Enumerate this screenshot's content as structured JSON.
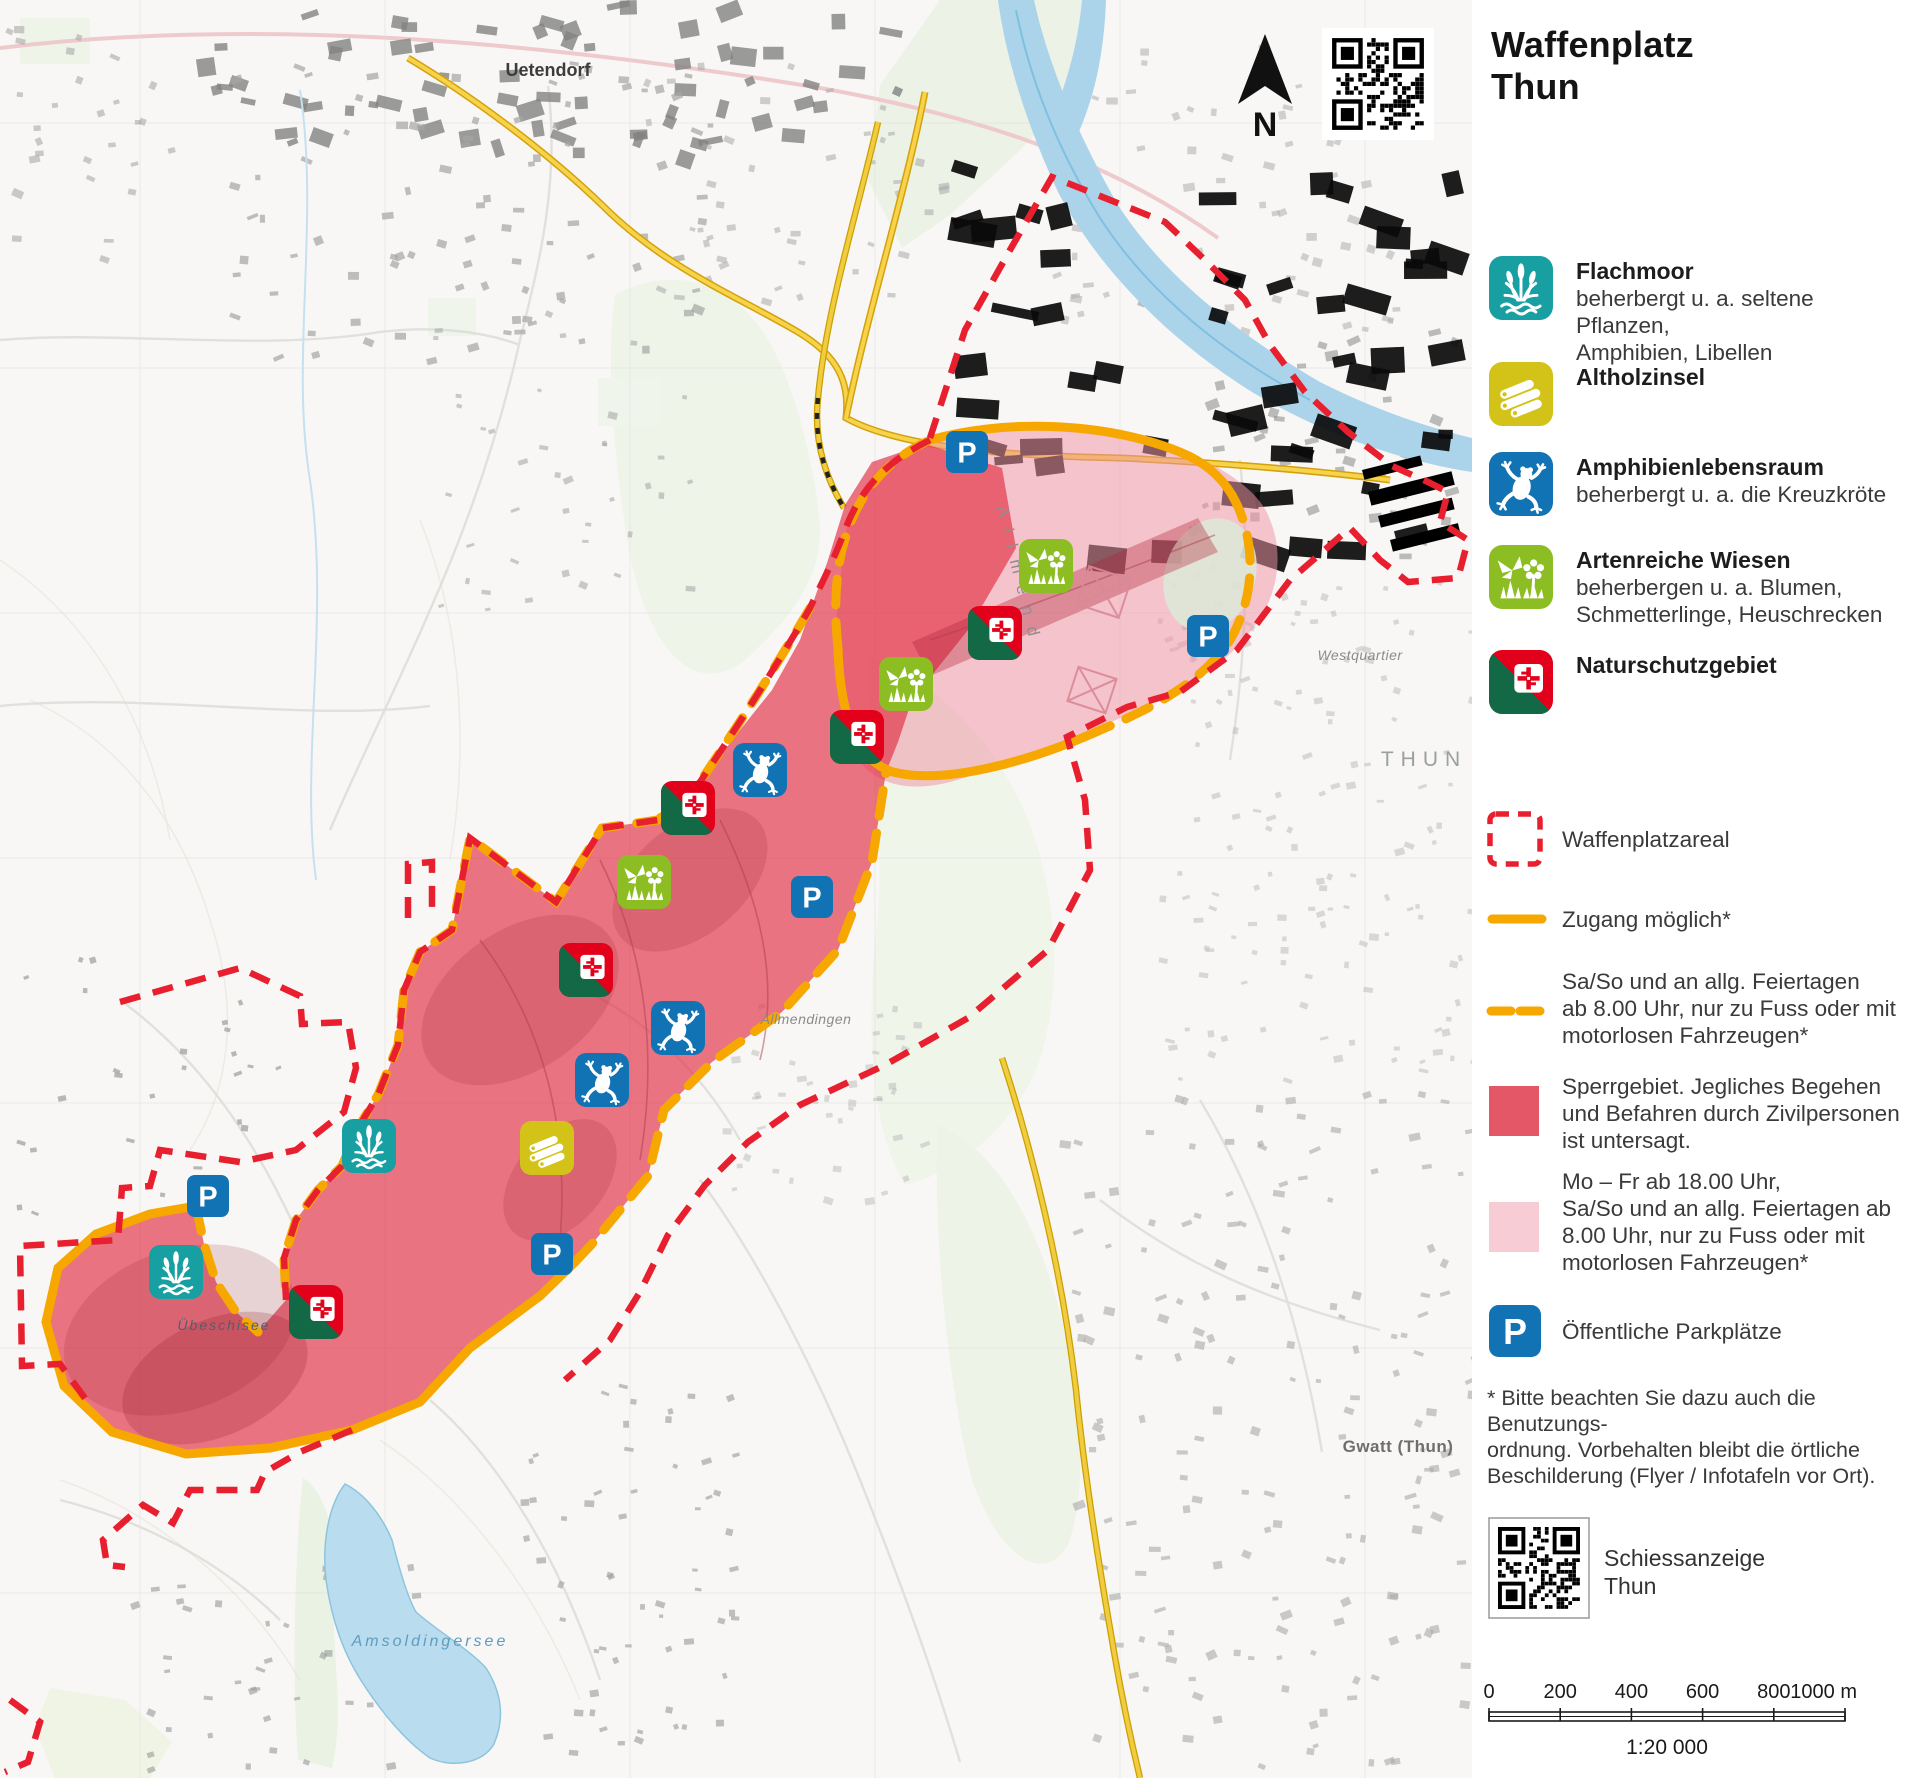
{
  "title": {
    "line1": "Waffenplatz",
    "line2": "Thun"
  },
  "compass": {
    "letter": "N"
  },
  "colors": {
    "teal": "#189fa2",
    "yellow": "#d3c318",
    "blue": "#1273b4",
    "green": "#8cbe23",
    "dark_green": "#136945",
    "swiss_red": "#e3001b",
    "boundary_red": "#e81f2e",
    "orange": "#f6a700",
    "sperr_red": "#e45767",
    "zone_pink": "#f7ccd4"
  },
  "legend": {
    "nature_items": [
      {
        "title": "Flachmoor",
        "desc": [
          "beherbergt u. a. seltene Pflanzen,",
          "Amphibien, Libellen"
        ]
      },
      {
        "title": "Altholzinsel",
        "desc": []
      },
      {
        "title": "Amphibienlebensraum",
        "desc": [
          "beherbergt u. a. die Kreuzkröte"
        ]
      },
      {
        "title": "Artenreiche Wiesen",
        "desc": [
          "beherbergen u. a. Blumen,",
          "Schmetterlinge, Heuschrecken"
        ]
      },
      {
        "title": "Naturschutzgebiet",
        "desc": []
      }
    ],
    "area_items": {
      "waffenplatzareal": "Waffenplatzareal",
      "zugang": "Zugang möglich*",
      "saso": [
        "Sa/So und an allg. Feiertagen",
        "ab 8.00 Uhr, nur zu Fuss oder mit",
        "motorlosen Fahrzeugen*"
      ],
      "sperr": [
        "Sperrgebiet. Jegliches Begehen",
        "und Befahren durch Zivilpersonen",
        "ist untersagt."
      ],
      "mofr": [
        "Mo – Fr ab 18.00 Uhr,",
        "Sa/So und an allg. Feiertagen ab",
        "8.00 Uhr, nur zu Fuss oder mit",
        "motorlosen Fahrzeugen*"
      ],
      "parking": "Öffentliche Parkplätze"
    },
    "footnote": [
      "* Bitte beachten Sie dazu auch die Benutzungs-",
      "ordnung. Vorbehalten bleibt die örtliche",
      "Beschilderung (Flyer / Infotafeln vor Ort)."
    ],
    "qr_label": [
      "Schiessanzeige",
      "Thun"
    ]
  },
  "scalebar": {
    "labels": [
      "0",
      "200",
      "400",
      "600",
      "800",
      "1000 m"
    ],
    "ratio": "1:20 000"
  },
  "map": {
    "labels": [
      {
        "t": "Uetendorf",
        "x": 548,
        "y": 76,
        "cls": "town"
      },
      {
        "t": "THUN",
        "x": 1424,
        "y": 766,
        "cls": "city"
      },
      {
        "t": "Westquartier",
        "x": 1360,
        "y": 660,
        "cls": "hamlet"
      },
      {
        "t": "Allmendingen",
        "x": 806,
        "y": 1024,
        "cls": "hamlet"
      },
      {
        "t": "Gwatt (Thun)",
        "x": 1398,
        "y": 1452,
        "cls": "place"
      },
      {
        "t": "Amsoldingersee",
        "x": 430,
        "y": 1646,
        "cls": "water"
      },
      {
        "t": "Übeschisee",
        "x": 224,
        "y": 1330,
        "cls": "water2"
      },
      {
        "t": "Allmend",
        "x": 1014,
        "y": 578,
        "cls": "area",
        "rot": 76
      }
    ],
    "markers": {
      "parking": [
        [
          967,
          452
        ],
        [
          1208,
          636
        ],
        [
          812,
          897
        ],
        [
          208,
          1196
        ],
        [
          552,
          1254
        ]
      ],
      "flachmoor": [
        [
          369,
          1146
        ],
        [
          176,
          1272
        ]
      ],
      "frog": [
        [
          760,
          770
        ],
        [
          678,
          1028
        ],
        [
          602,
          1080
        ]
      ],
      "wiesen": [
        [
          1046,
          566
        ],
        [
          906,
          684
        ],
        [
          644,
          882
        ]
      ],
      "naturschutz": [
        [
          995,
          633
        ],
        [
          857,
          737
        ],
        [
          688,
          808
        ],
        [
          586,
          970
        ],
        [
          316,
          1312
        ]
      ],
      "altholz": [
        [
          547,
          1148
        ]
      ]
    }
  }
}
